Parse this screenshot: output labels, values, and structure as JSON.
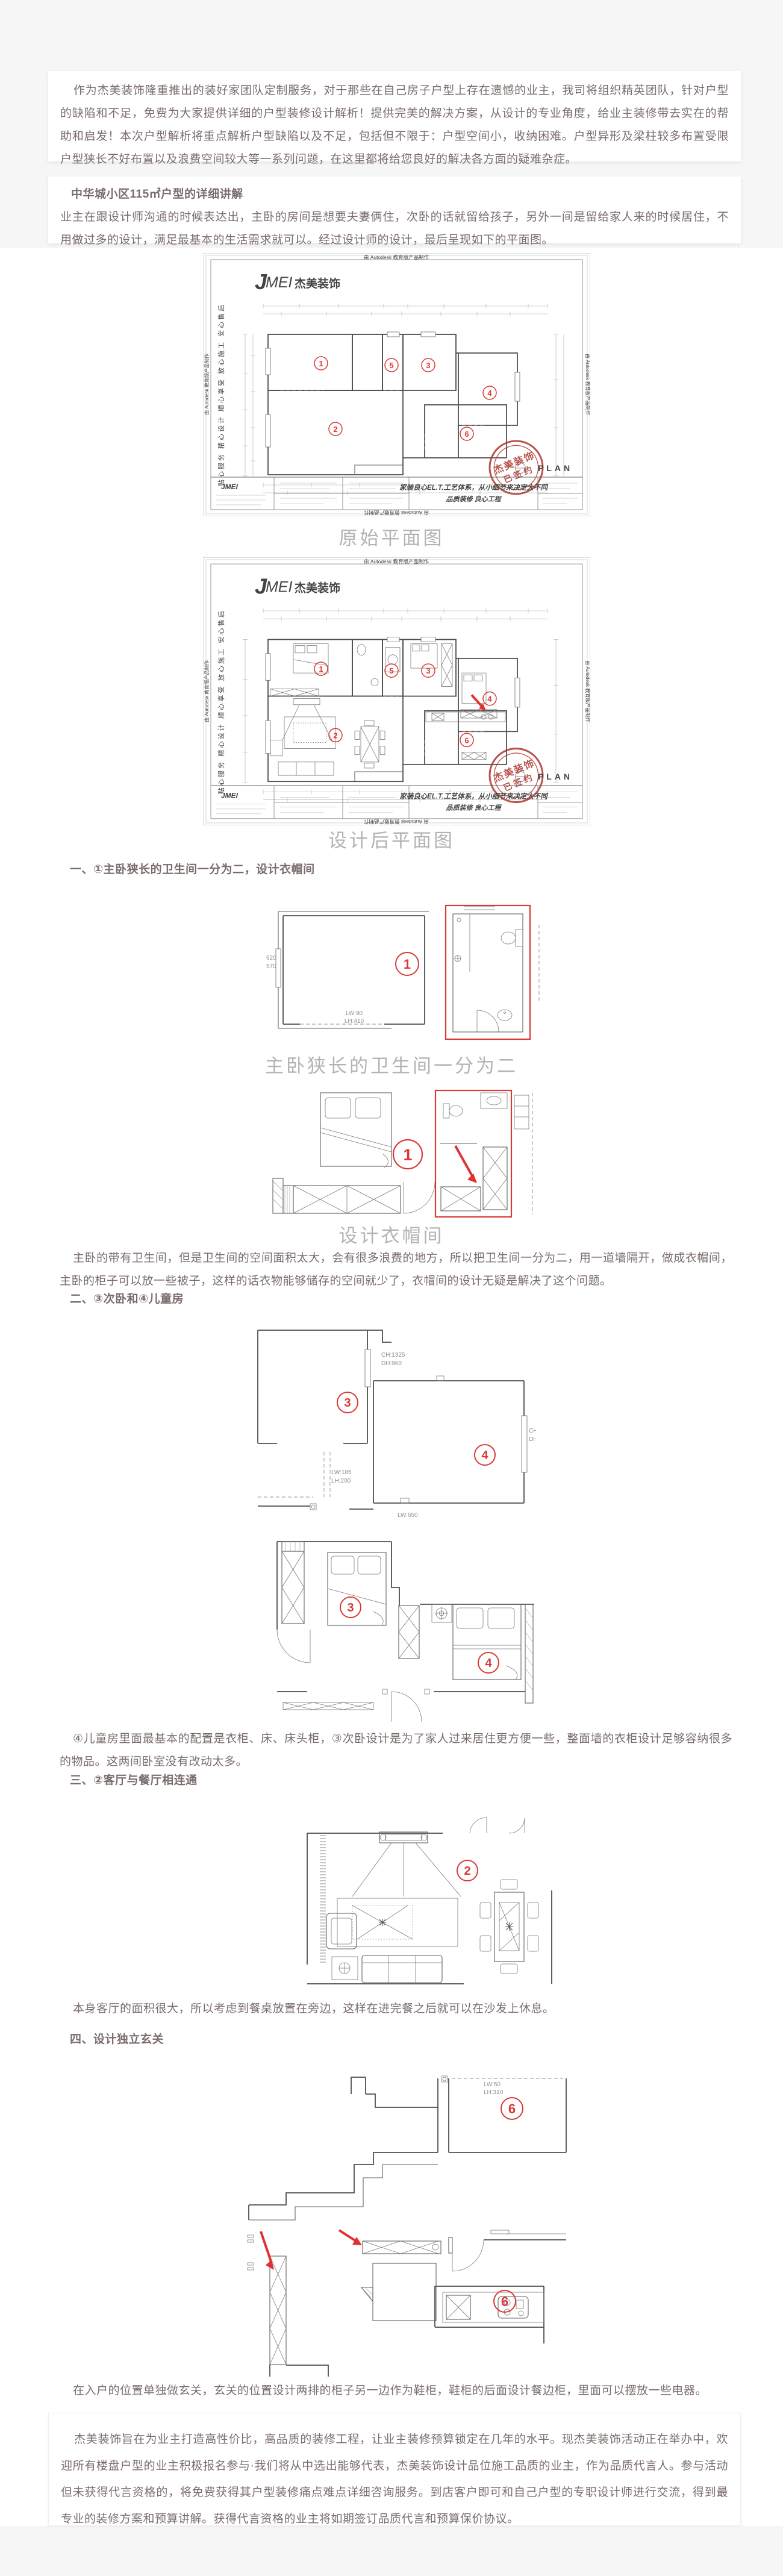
{
  "colors": {
    "accent_red": "#d93a36",
    "stamp_red": "#b03a33",
    "body_text": "#7b6c6c",
    "caption_gray": "#b5b2b2",
    "wall_gray": "#4f4f4f",
    "page_bg": "#f6f6f7"
  },
  "intro_card": {
    "text": "作为杰美装饰隆重推出的装好家团队定制服务，对于那些在自己房子户型上存在遗憾的业主，我司将组织精英团队，针对户型的缺陷和不足，免费为大家提供详细的户型装修设计解析！提供完美的解决方案，从设计的专业角度，给业主装修带去实在的帮助和启发！本次户型解析将重点解析户型缺陷以及不足，包括但不限于：户型空间小，收纳困难。户型异形及梁柱较多布置受限户型狭长不好布置以及浪费空间较大等一系列问题，在这里都将给您良好的解决各方面的疑难杂症。"
  },
  "section_card": {
    "title": "中华城小区115㎡户型的详细讲解",
    "text": "业主在跟设计师沟通的时候表达出，主卧的房间是想要夫妻俩住，次卧的话就留给孩子，另外一间是留给家人来的时候居住，不用做过多的设计，满足最基本的生活需求就可以。经过设计师的设计，最后呈现如下的平面图。"
  },
  "plan_sheet": {
    "autodesk_credit": "由 Autodesk 教育版产品制作",
    "logo": {
      "j": "J",
      "mei": "MEI",
      "cn": "杰美装饰"
    },
    "side_slogan": "贴心服务  精心设计  顺心享受  放心施工  安心售后",
    "stamp": {
      "line1": "杰美装饰",
      "line2": "已签约"
    },
    "title_block": {
      "slogan1": "家装良心EL.T.工艺体系，从小细节来决定大不同",
      "slogan2": "品质装修 良心工程",
      "sheet_label": "PLAN",
      "logo_small": "JMEI"
    },
    "room_markers": {
      "r1": "1",
      "r2": "2",
      "r3": "3",
      "r4": "4",
      "r5": "5",
      "r6": "6"
    }
  },
  "figures": {
    "plan_original_caption": "原始平面图",
    "plan_designed_caption": "设计后平面图",
    "d1_caption": "主卧狭长的卫生间一分为二",
    "d2_caption": "设计衣帽间",
    "d1_labels": {
      "lw": "LW:90",
      "lh": "LH:410",
      "dim1": "620",
      "dim2": "570"
    },
    "d3_labels": {
      "ch": "CH:1325",
      "dh": "DH:960",
      "lw": "LW:185",
      "lh": "LH:200",
      "lw2": "LW:650",
      "ch2": "CH",
      "dh2": "DH"
    },
    "d6_labels": {
      "lw": "LW:50",
      "lh": "LH:310"
    }
  },
  "sections": {
    "s1": {
      "heading": "一、①主卧狭长的卫生间一分为二，设计衣帽间",
      "body": "主卧的带有卫生间，但是卫生间的空间面积太大，会有很多浪费的地方，所以把卫生间一分为二，用一道墙隔开，做成衣帽间，主卧的柜子可以放一些被子，这样的话衣物能够储存的空间就少了，衣帽间的设计无疑是解决了这个问题。"
    },
    "s2": {
      "heading": "二、③次卧和④儿童房",
      "body": "④儿童房里面最基本的配置是衣柜、床、床头柜，③次卧设计是为了家人过来居住更方便一些，整面墙的衣柜设计足够容纳很多的物品。这两间卧室没有改动太多。"
    },
    "s3": {
      "heading": "三、②客厅与餐厅相连通",
      "body": "本身客厅的面积很大，所以考虑到餐桌放置在旁边，这样在进完餐之后就可以在沙发上休息。"
    },
    "s4": {
      "heading": "四、设计独立玄关",
      "body": "在入户的位置单独做玄关，玄关的位置设计两排的柜子另一边作为鞋柜，鞋柜的后面设计餐边柜，里面可以摆放一些电器。"
    }
  },
  "footer_card": {
    "text": "杰美装饰旨在为业主打造高性价比，高品质的装修工程，让业主装修预算锁定在几年的水平。现杰美装饰活动正在举办中，欢迎所有楼盘户型的业主积极报名参与·我们将从中选出能够代表，杰美装饰设计品位施工品质的业主，作为品质代言人。参与活动但未获得代言资格的，将免费获得其户型装修痛点难点详细咨询服务。到店客户即可和自己户型的专职设计师进行交流，得到最专业的装修方案和预算讲解。获得代言资格的业主将如期签订品质代言和预算保价协议。"
  }
}
